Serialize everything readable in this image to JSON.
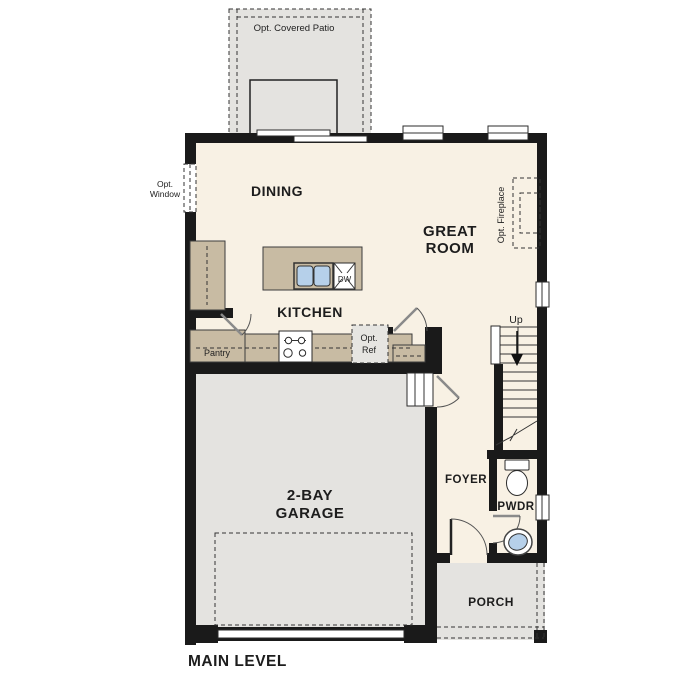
{
  "plan_title": "MAIN LEVEL",
  "colors": {
    "interior_floor": "#f8f1e4",
    "hard_surface": "#e4e3e0",
    "counter_tan": "#c8bba3",
    "sink_blue": "#b6d0ea",
    "wall_black": "#1a1a1a"
  },
  "rooms": {
    "patio": {
      "label": "Opt. Covered Patio"
    },
    "dining": {
      "label": "DINING"
    },
    "great_room": {
      "label_line1": "GREAT",
      "label_line2": "ROOM"
    },
    "kitchen": {
      "label": "KITCHEN"
    },
    "pantry": {
      "label": "Pantry"
    },
    "garage": {
      "label_line1": "2-BAY",
      "label_line2": "GARAGE"
    },
    "foyer": {
      "label": "FOYER"
    },
    "powder_room": {
      "label": "PWDR"
    },
    "porch": {
      "label": "PORCH"
    },
    "stairs": {
      "direction_label": "Up"
    }
  },
  "features": {
    "optional_window": {
      "label_line1": "Opt.",
      "label_line2": "Window"
    },
    "optional_fireplace": {
      "label": "Opt. Fireplace"
    },
    "optional_refrigerator": {
      "label_line1": "Opt.",
      "label_line2": "Ref"
    },
    "dishwasher": {
      "label": "DW"
    }
  }
}
